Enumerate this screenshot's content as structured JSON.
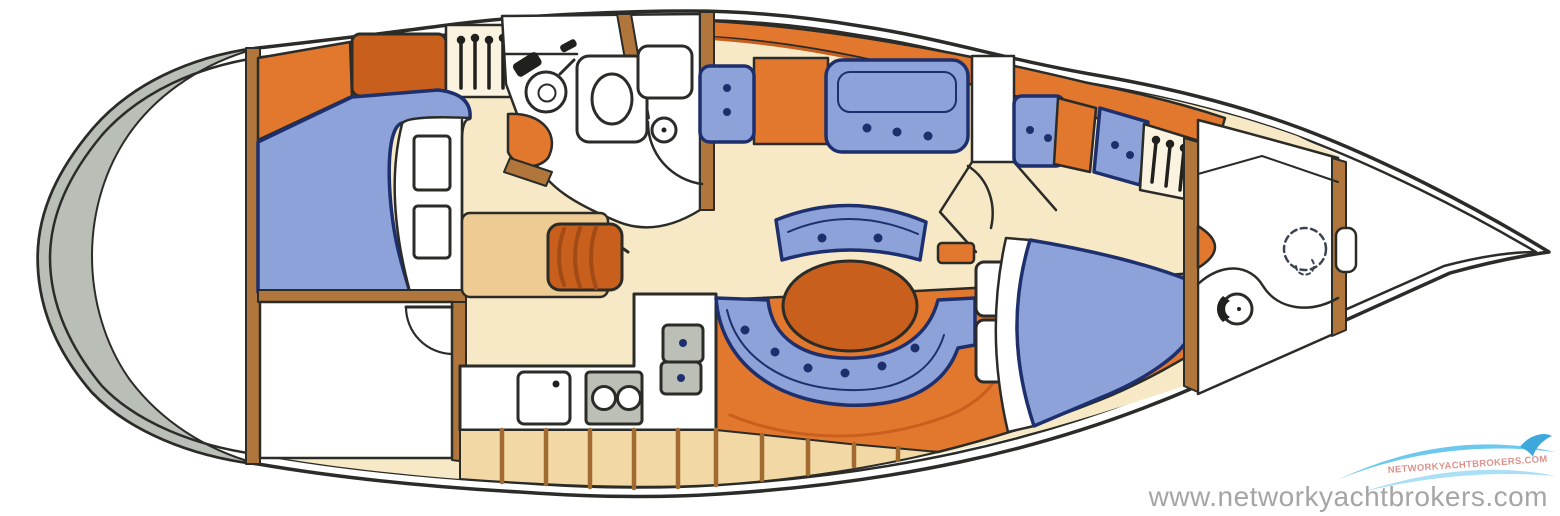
{
  "watermark": {
    "url_text": "www.networkyachtbrokers.com",
    "logo_text": "NETWORKYACHTBROKERS.COM"
  },
  "palette": {
    "hullline": "#2b2b28",
    "navy": "#1e2f6e",
    "blue": "#8da2d8",
    "orange": "#e2772e",
    "orangedeep": "#c95f1d",
    "cream": "#f7e9c6",
    "tan": "#eecb92",
    "tanlocker": "#f2d8a4",
    "wood": "#b0763c",
    "graytransom": "#b9bfb6",
    "grayappliance": "#bcbfb6",
    "watermarkgray": "#a5a5a5",
    "logoblue": "#6cc8ee",
    "logobluelight": "#aadff5",
    "logored": "#c03a30"
  }
}
